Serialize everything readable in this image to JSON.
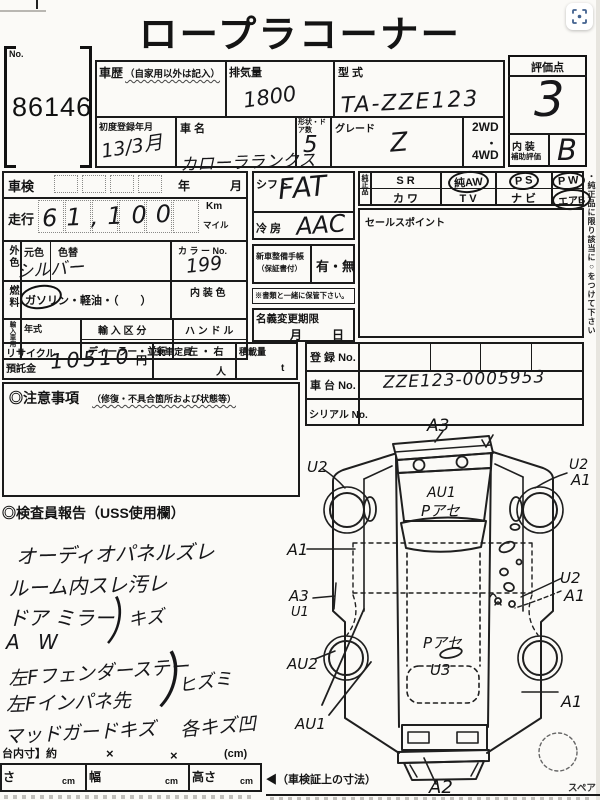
{
  "colors": {
    "ink": "#1a1a1a",
    "paper": "#fbfaf7",
    "accent_blue": "#41618e"
  },
  "ui": {
    "capture_button_icon": "focus-frame-icon"
  },
  "title": "ロープラコーナー",
  "header": {
    "no_label": "No.",
    "lot_no": "86146",
    "history_label": "車歴",
    "history_note": "（自家用以外は記入）",
    "displacement_label": "排気量",
    "displacement_value": "1800",
    "model_label": "型 式",
    "model_value": "TA-ZZE123",
    "first_reg_label": "初度登録年月",
    "first_reg_value": "13/3月",
    "car_name_label": "車 名",
    "car_name_value": "カローラランクス",
    "doors_label": "形状・ドア数",
    "doors_value": "5",
    "grade_label": "グレード",
    "grade_value": "Z",
    "drive_opt1": "2WD",
    "drive_dot": "・",
    "drive_opt2": "4WD",
    "score_label": "評価点",
    "score_value": "3",
    "interior_label1": "内 装",
    "interior_label2": "補助評価",
    "interior_value": "B"
  },
  "left": {
    "shaken_label": "車検",
    "year": "年",
    "month": "月",
    "mileage_label": "走行",
    "mileage_value": "61,100",
    "unit_km": "Km",
    "unit_mile": "マイル",
    "color_side": "外色",
    "base_color": "元色",
    "repaint": "色替",
    "color_value": "シルバー",
    "color_no_label": "カ ラ ー No.",
    "color_no_value": "199",
    "fuel_side": "燃料",
    "fuel_value": "ガソリン・軽油・（　　）",
    "interior_color_label": "内 装 色",
    "import_side": "輸入車用",
    "import_year": "年式",
    "import_class_label": "輸 入 区 分",
    "import_class_value": "ディーラー・並行",
    "handle_label": "ハ ン ド ル",
    "handle_value": "左 ・ 右"
  },
  "mid": {
    "shift_label": "シフト",
    "shift_value": "FAT",
    "ac_label": "冷 房",
    "ac_value": "AAC",
    "book_label": "新車整備手帳",
    "book_sub": "（保証書付）",
    "book_value": "有・無",
    "keep_note": "※書類と一緒に保管下さい。",
    "transfer_label": "名義変更期限",
    "transfer_month": "月",
    "transfer_day": "日"
  },
  "genuine": {
    "side_label": "純正品",
    "row1": [
      {
        "label": "S R",
        "circled": false
      },
      {
        "label": "純AW",
        "circled": true
      },
      {
        "label": "P S",
        "circled": true
      },
      {
        "label": "P W",
        "circled": true
      }
    ],
    "row2": [
      {
        "label": "カ ワ",
        "circled": false
      },
      {
        "label": "T V",
        "circled": false
      },
      {
        "label": "ナ ビ",
        "circled": false
      },
      {
        "label": "エアB",
        "circled": true
      }
    ],
    "vertical_note": "・純正品に限り該当に○をつけて下さい",
    "sales_point_label": "セールスポイント"
  },
  "recycle": {
    "label1": "リサイクル",
    "label2": "預託金",
    "value": "10510",
    "unit": "円",
    "capacity_label": "乗車定員",
    "capacity_unit": "人",
    "load_label": "積載量",
    "load_unit": "t"
  },
  "caution": {
    "label": "◎注意事項",
    "sub": "（修復・不具合箇所および状態等）"
  },
  "registration": {
    "reg_label": "登 録 No.",
    "chassis_label": "車 台 No.",
    "chassis_value": "ZZE123-0005953",
    "serial_label": "シリアル No."
  },
  "inspector": {
    "header": "◎検査員報告（USS使用欄）",
    "line1": "オーディオパネルズレ",
    "line2": "ルーム内スレ汚レ",
    "line3": "ドア ミラー",
    "line4": "A W",
    "brace1_label": "キズ",
    "line5": "左Fフェンダーステー",
    "line6": "左Fインパネ先",
    "brace2_label": "ヒズミ",
    "line7": "マッドガードキズ",
    "tail": "各キズ凹"
  },
  "diagram": {
    "front": "A3",
    "front_left_u2": "U2",
    "front_right_u2": "U2",
    "front_right_a1": "A1",
    "hood1": "AU1",
    "hood2": "Pアセ",
    "left_a1": "A1",
    "left_a3": "A3",
    "left_u1": "U1",
    "right_u2": "U2",
    "right_a1": "A1",
    "left_rear_au2": "AU2",
    "left_rear_au1": "AU1",
    "roof1": "Pアセ",
    "roof2": "U3",
    "right_rear_a1": "A1",
    "rear": "A2",
    "spare_label": "スペア"
  },
  "dims": {
    "inner_label": "台内寸】約",
    "x1": "×",
    "x2": "×",
    "unit": "(cm)",
    "len_label": "さ",
    "len_unit": "cm",
    "width_label": "幅",
    "width_unit": "cm",
    "height_label": "高さ",
    "height_unit": "cm",
    "arrow": "◀",
    "shaken_note": "（車検証上の寸法）"
  }
}
